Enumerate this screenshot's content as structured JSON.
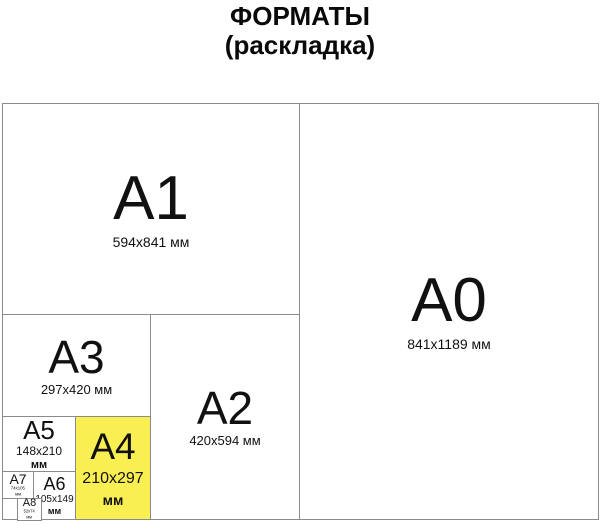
{
  "title": {
    "line1": "ФОРМАТЫ",
    "line2": "(раскладка)"
  },
  "colors": {
    "highlight": "#F9EE52",
    "border": "#8b8b8b"
  },
  "cells": {
    "a0": {
      "label": "A0",
      "dims": "841x1189 мм"
    },
    "a1": {
      "label": "A1",
      "dims": "594x841 мм"
    },
    "a2": {
      "label": "A2",
      "dims": "420x594 мм"
    },
    "a3": {
      "label": "A3",
      "dims": "297x420 мм"
    },
    "a4": {
      "label": "A4",
      "dims": "210x297",
      "unit": "мм"
    },
    "a5": {
      "label": "A5",
      "dims": "148x210",
      "unit": "мм"
    },
    "a6": {
      "label": "A6",
      "dims": "105x149",
      "unit": "мм"
    },
    "a7": {
      "label": "A7",
      "dims": "74x105",
      "unit": "мм"
    },
    "a8": {
      "label": "A8",
      "dims": "52x74",
      "unit": "мм"
    }
  }
}
